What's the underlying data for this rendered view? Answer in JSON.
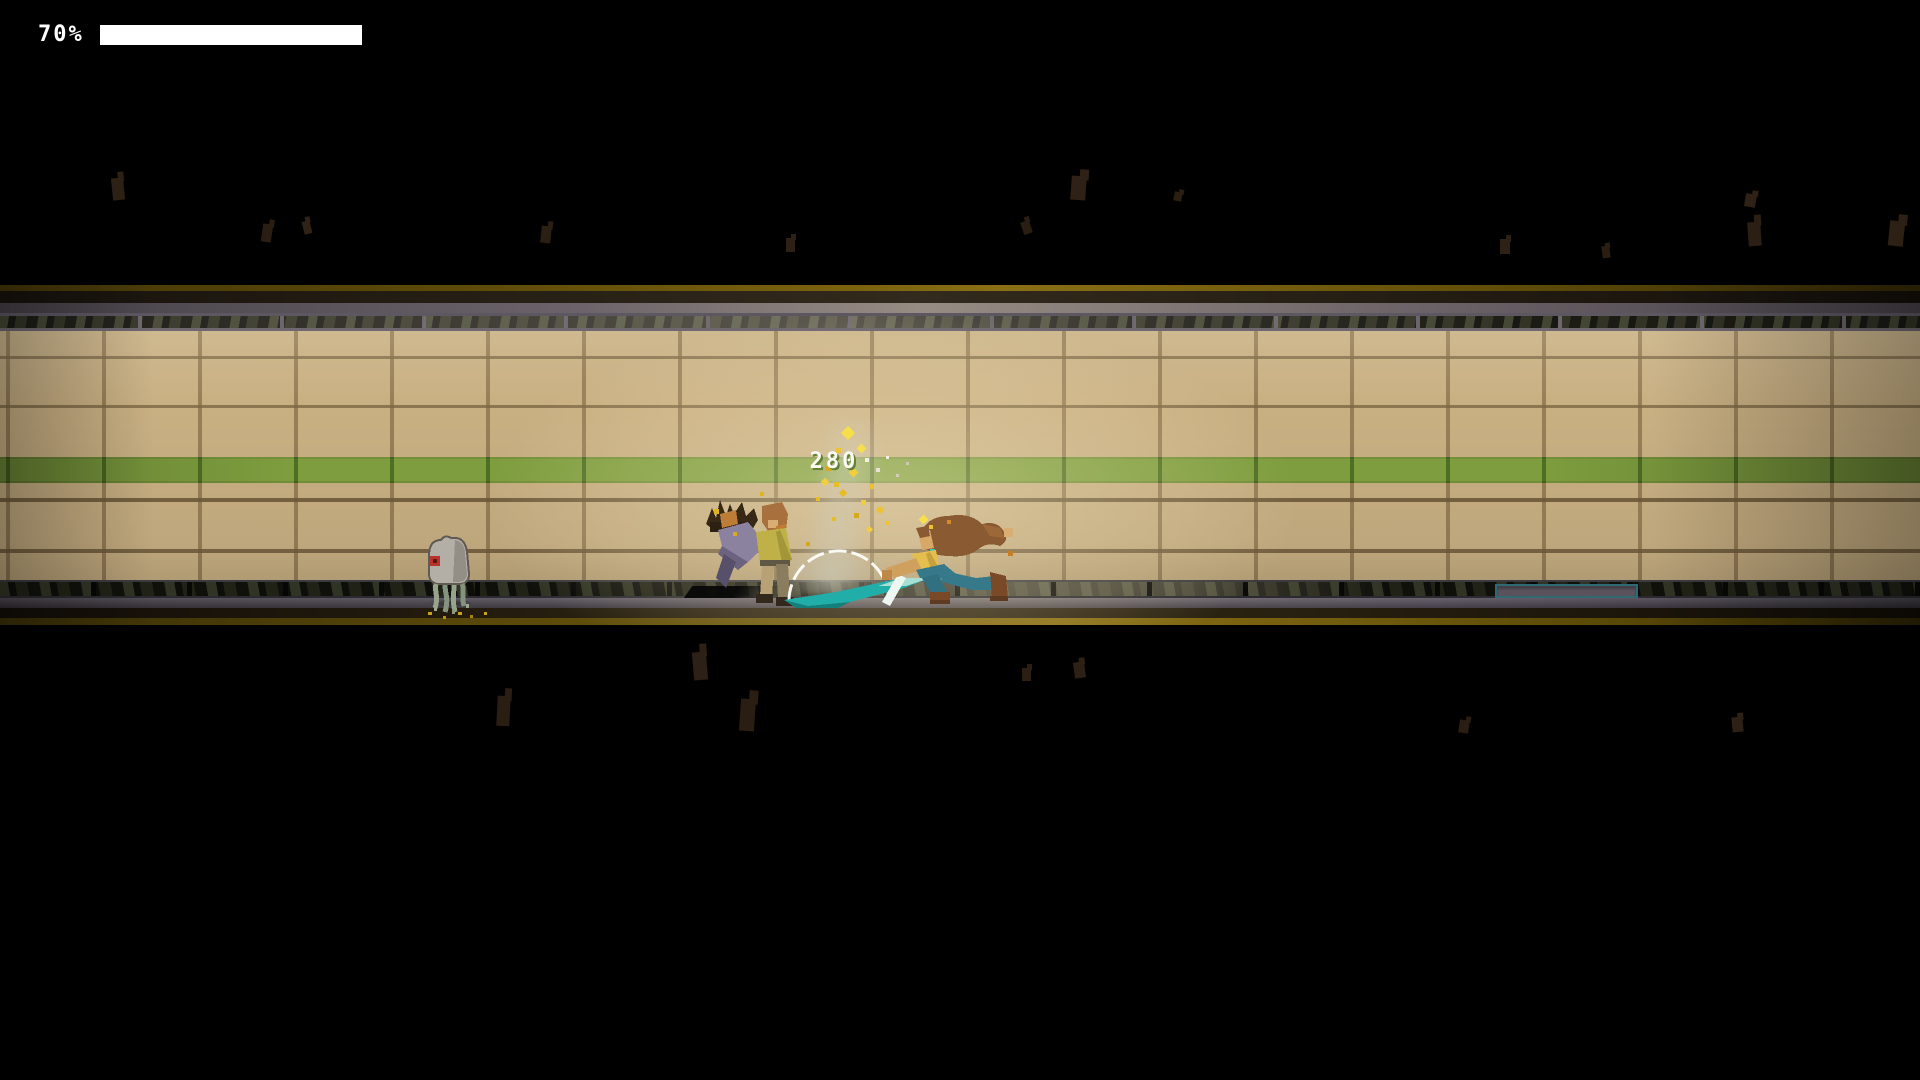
{
  "hud": {
    "health_label": "70%",
    "health_bar_fill_percent": 100
  },
  "combat": {
    "damage_value": "280"
  },
  "palette": {
    "background": "#000000",
    "wall_tile": "#c9b083",
    "accent_stripe": "#7d9d3e",
    "gold_trim": "#8a6f14",
    "hud_bar": "#ffffff",
    "damage_text": "#fafaf2",
    "slash_teal": "#22aea8",
    "spark_yellow": "#f2cf3a",
    "creature_eye": "#b8332a",
    "platform_panel_border": "#2f6a74"
  },
  "particles": {
    "debris": [
      [
        112,
        178,
        12,
        22,
        -6,
        "#2d2014"
      ],
      [
        262,
        224,
        10,
        18,
        8,
        "#2a1e12"
      ],
      [
        303,
        221,
        8,
        13,
        -14,
        "#302216"
      ],
      [
        541,
        226,
        10,
        17,
        6,
        "#2b1f13"
      ],
      [
        786,
        238,
        9,
        14,
        0,
        "#2d2014"
      ],
      [
        1022,
        221,
        9,
        13,
        -18,
        "#2a1e12"
      ],
      [
        1071,
        176,
        15,
        24,
        4,
        "#2f2115"
      ],
      [
        1174,
        192,
        8,
        9,
        12,
        "#2b1f13"
      ],
      [
        1500,
        239,
        10,
        15,
        0,
        "#2d2014"
      ],
      [
        1602,
        246,
        8,
        12,
        -8,
        "#2a1e12"
      ],
      [
        1745,
        194,
        11,
        13,
        10,
        "#2f2115"
      ],
      [
        1748,
        222,
        13,
        24,
        -4,
        "#2b1f13"
      ],
      [
        1889,
        221,
        15,
        25,
        6,
        "#2d2014"
      ],
      [
        497,
        696,
        13,
        30,
        3,
        "#2a1d12"
      ],
      [
        693,
        652,
        14,
        28,
        -5,
        "#2d2014"
      ],
      [
        740,
        699,
        15,
        32,
        4,
        "#2a1d12"
      ],
      [
        1022,
        668,
        9,
        13,
        0,
        "#2b1f13"
      ],
      [
        1074,
        662,
        11,
        16,
        -8,
        "#2d2014"
      ],
      [
        1459,
        720,
        10,
        13,
        8,
        "#2a1d12"
      ],
      [
        1732,
        717,
        11,
        15,
        -5,
        "#2d2014"
      ]
    ],
    "sparks": [
      [
        843,
        428,
        10,
        10,
        45,
        "#f6df4a"
      ],
      [
        836,
        448,
        5,
        5,
        0,
        "#edc32f"
      ],
      [
        858,
        445,
        7,
        7,
        45,
        "#f6df4a"
      ],
      [
        826,
        466,
        5,
        5,
        0,
        "#d8a81e"
      ],
      [
        850,
        469,
        7,
        7,
        45,
        "#f2cf3a"
      ],
      [
        869,
        484,
        5,
        5,
        0,
        "#edc32f"
      ],
      [
        840,
        490,
        6,
        6,
        45,
        "#e8bc24"
      ],
      [
        861,
        500,
        5,
        5,
        0,
        "#f2cf3a"
      ],
      [
        877,
        507,
        6,
        6,
        45,
        "#edc32f"
      ],
      [
        854,
        513,
        5,
        5,
        0,
        "#d8a81e"
      ],
      [
        832,
        517,
        4,
        4,
        0,
        "#e8bc24"
      ],
      [
        867,
        527,
        5,
        5,
        45,
        "#f2cf3a"
      ],
      [
        885,
        521,
        4,
        4,
        0,
        "#edc32f"
      ],
      [
        920,
        516,
        7,
        7,
        45,
        "#f6df4a"
      ],
      [
        929,
        525,
        4,
        4,
        0,
        "#edc32f"
      ],
      [
        806,
        542,
        4,
        4,
        0,
        "#d8a81e"
      ],
      [
        816,
        497,
        4,
        4,
        0,
        "#e8bc24"
      ],
      [
        714,
        509,
        5,
        5,
        0,
        "#e0b41e"
      ],
      [
        733,
        532,
        4,
        4,
        0,
        "#d8a81e"
      ],
      [
        760,
        492,
        4,
        4,
        0,
        "#e0b41e"
      ],
      [
        822,
        479,
        6,
        6,
        45,
        "#f2cf3a"
      ],
      [
        834,
        482,
        5,
        5,
        0,
        "#e8bc24"
      ],
      [
        865,
        458,
        4,
        4,
        0,
        "#f2eee2"
      ],
      [
        876,
        468,
        4,
        4,
        0,
        "#e8e2d2"
      ],
      [
        886,
        456,
        3,
        3,
        0,
        "#f2eee2"
      ],
      [
        896,
        474,
        3,
        3,
        0,
        "#d5cebc"
      ],
      [
        906,
        462,
        3,
        3,
        0,
        "#cfc8b6"
      ],
      [
        947,
        520,
        4,
        4,
        0,
        "#d88a2a"
      ],
      [
        1008,
        551,
        5,
        5,
        0,
        "#c87f24"
      ],
      [
        428,
        612,
        4,
        3,
        0,
        "#caa21a"
      ],
      [
        443,
        616,
        3,
        3,
        0,
        "#b8920f"
      ],
      [
        458,
        612,
        4,
        3,
        0,
        "#caa21a"
      ],
      [
        470,
        615,
        3,
        3,
        0,
        "#a8850c"
      ],
      [
        484,
        612,
        3,
        3,
        0,
        "#caa21a"
      ],
      [
        434,
        606,
        3,
        5,
        0,
        "#9aa88e"
      ],
      [
        452,
        609,
        3,
        5,
        0,
        "#8a9880"
      ],
      [
        466,
        604,
        3,
        4,
        0,
        "#9aa88e"
      ]
    ]
  }
}
